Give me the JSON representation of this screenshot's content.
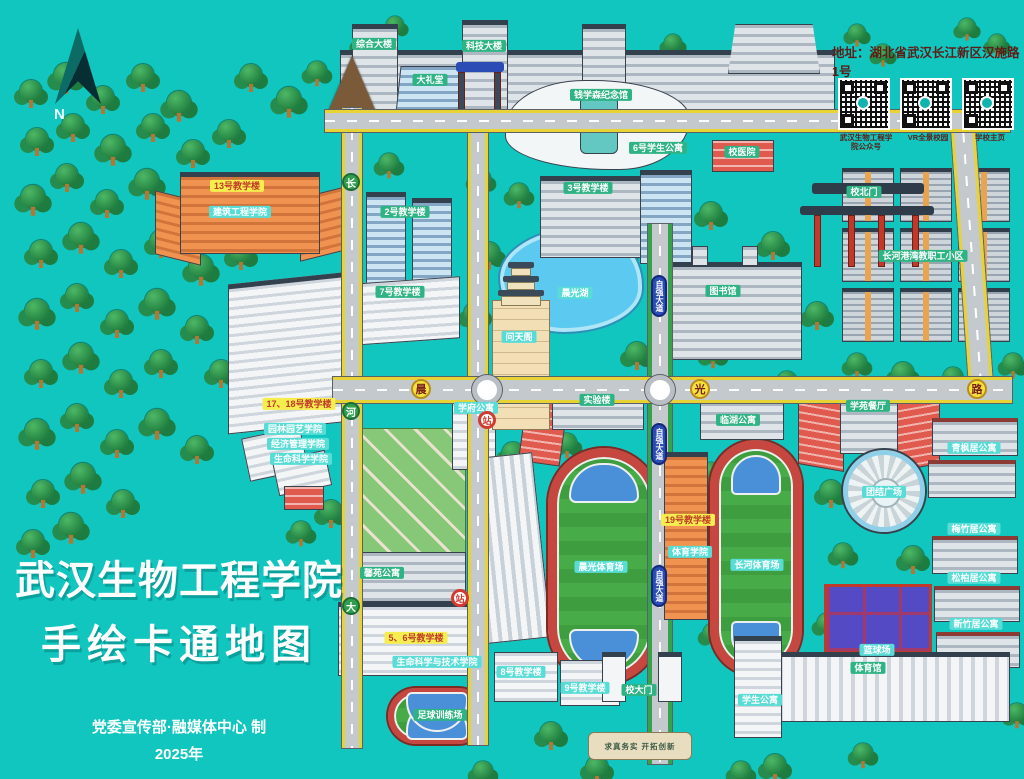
{
  "map": {
    "title": {
      "line1": "武汉生物工程学院",
      "line2": "手绘卡通地图",
      "credit": "党委宣传部·融媒体中心 制",
      "year": "2025年"
    },
    "address": "地址：湖北省武汉长江新区汉施路1号",
    "compass_label": "N",
    "qr_codes": [
      {
        "label": "武汉生物工程学院公众号"
      },
      {
        "label": "VR全景校园"
      },
      {
        "label": "学校主页"
      }
    ],
    "gate_motto": "求真务实 开拓创新",
    "colors": {
      "background": "#10c6bf",
      "label_green": "#2eb384",
      "label_yellow": "#f6ee4e",
      "label_cyan": "#58ddd6",
      "road": "#c3c9cd",
      "road_edge": "#e8d335",
      "lake": "#5bc9f0",
      "field_green": "#3e9e3f",
      "track_red": "#c5473f"
    },
    "pois": [
      {
        "id": "poi-zonghe-tower",
        "label": "综合大楼",
        "x": 374,
        "y": 44,
        "v": "green"
      },
      {
        "id": "poi-keji-tower",
        "label": "科技大楼",
        "x": 484,
        "y": 46,
        "v": "green"
      },
      {
        "id": "poi-dalitang",
        "label": "大礼堂",
        "x": 430,
        "y": 80,
        "v": "green"
      },
      {
        "id": "poi-qianxuesen-hall",
        "label": "钱学森纪念馆",
        "x": 601,
        "y": 95,
        "v": "green"
      },
      {
        "id": "poi-xiaoyiyuan",
        "label": "校医院",
        "x": 742,
        "y": 152,
        "v": "green"
      },
      {
        "id": "poi-xuesheng-gongyu-6",
        "label": "6号学生公寓",
        "x": 658,
        "y": 148,
        "v": "green"
      },
      {
        "id": "poi-xiao-bei-men",
        "label": "校北门",
        "x": 864,
        "y": 192,
        "v": "green"
      },
      {
        "id": "poi-jiaoxuelou-13",
        "label": "13号教学楼",
        "x": 237,
        "y": 186,
        "v": "yellow"
      },
      {
        "id": "poi-jianzhu-xueyuan",
        "label": "建筑工程学院",
        "x": 240,
        "y": 212,
        "v": "cyan"
      },
      {
        "id": "poi-jiaoxuelou-2",
        "label": "2号教学楼",
        "x": 405,
        "y": 212,
        "v": "green"
      },
      {
        "id": "poi-jiaoxuelou-3",
        "label": "3号教学楼",
        "x": 588,
        "y": 188,
        "v": "green"
      },
      {
        "id": "poi-jiaoxuelou-7",
        "label": "7号教学楼",
        "x": 400,
        "y": 292,
        "v": "green"
      },
      {
        "id": "poi-chenguang-lake",
        "label": "晨光湖",
        "x": 575,
        "y": 293,
        "v": "cyan"
      },
      {
        "id": "poi-wentiange",
        "label": "问天阁",
        "x": 519,
        "y": 337,
        "v": "cyan"
      },
      {
        "id": "poi-tushuguan",
        "label": "图书馆",
        "x": 723,
        "y": 291,
        "v": "green"
      },
      {
        "id": "poi-changhe-gangwan",
        "label": "长河港湾教职工小区",
        "x": 923,
        "y": 256,
        "v": "green"
      },
      {
        "id": "poi-jiaoxuelou-17-18",
        "label": "17、18号教学楼",
        "x": 299,
        "y": 404,
        "v": "yellow"
      },
      {
        "id": "poi-yuanlin-xueyuan",
        "label": "园林园艺学院",
        "x": 295,
        "y": 429,
        "v": "cyan"
      },
      {
        "id": "poi-jingguan-xueyuan",
        "label": "经济管理学院",
        "x": 298,
        "y": 444,
        "v": "cyan"
      },
      {
        "id": "poi-shengming-xueyuan",
        "label": "生命科学学院",
        "x": 301,
        "y": 459,
        "v": "cyan"
      },
      {
        "id": "poi-xuefu-gongyu",
        "label": "学府公寓",
        "x": 476,
        "y": 408,
        "v": "cyan"
      },
      {
        "id": "poi-shiyanlou",
        "label": "实验楼",
        "x": 597,
        "y": 400,
        "v": "green"
      },
      {
        "id": "poi-linhu-gongyu",
        "label": "临湖公寓",
        "x": 738,
        "y": 420,
        "v": "green"
      },
      {
        "id": "poi-xueyuan-canting",
        "label": "学苑餐厅",
        "x": 868,
        "y": 406,
        "v": "green"
      },
      {
        "id": "poi-tuanjie-guangchang",
        "label": "团结广场",
        "x": 884,
        "y": 492,
        "v": "cyan"
      },
      {
        "id": "poi-jiaoxuelou-19",
        "label": "19号教学楼",
        "x": 688,
        "y": 520,
        "v": "yellow"
      },
      {
        "id": "poi-tiyu-xueyuan",
        "label": "体育学院",
        "x": 690,
        "y": 552,
        "v": "cyan"
      },
      {
        "id": "poi-chenguang-stadium",
        "label": "晨光体育场",
        "x": 601,
        "y": 567,
        "v": "cyan"
      },
      {
        "id": "poi-changhe-stadium",
        "label": "长河体育场",
        "x": 757,
        "y": 565,
        "v": "cyan"
      },
      {
        "id": "poi-qingfengju",
        "label": "青枫居公寓",
        "x": 974,
        "y": 448,
        "v": "cyan"
      },
      {
        "id": "poi-meizhuju",
        "label": "梅竹居公寓",
        "x": 974,
        "y": 529,
        "v": "cyan"
      },
      {
        "id": "poi-songbaiju",
        "label": "松柏居公寓",
        "x": 974,
        "y": 578,
        "v": "cyan"
      },
      {
        "id": "poi-xinzhuju",
        "label": "新竹居公寓",
        "x": 976,
        "y": 624,
        "v": "cyan"
      },
      {
        "id": "poi-lanqiuchang",
        "label": "篮球场",
        "x": 877,
        "y": 650,
        "v": "cyan"
      },
      {
        "id": "poi-tiyuguan",
        "label": "体育馆",
        "x": 868,
        "y": 668,
        "v": "green"
      },
      {
        "id": "poi-xinyuan-gongyu",
        "label": "馨苑公寓",
        "x": 382,
        "y": 573,
        "v": "green"
      },
      {
        "id": "poi-jiaoxuelou-5-6",
        "label": "5、6号教学楼",
        "x": 416,
        "y": 638,
        "v": "yellow"
      },
      {
        "id": "poi-shengming-jishu",
        "label": "生命科学与技术学院",
        "x": 437,
        "y": 662,
        "v": "cyan"
      },
      {
        "id": "poi-zuqiu-xunlianchang",
        "label": "足球训练场",
        "x": 440,
        "y": 715,
        "v": "green"
      },
      {
        "id": "poi-jiaoxuelou-8",
        "label": "8号教学楼",
        "x": 521,
        "y": 672,
        "v": "cyan"
      },
      {
        "id": "poi-jiaoxuelou-9",
        "label": "9号教学楼",
        "x": 585,
        "y": 688,
        "v": "cyan"
      },
      {
        "id": "poi-xuesheng-gongyu-r",
        "label": "学生公寓",
        "x": 760,
        "y": 700,
        "v": "cyan"
      },
      {
        "id": "poi-xiao-da-men",
        "label": "校大门",
        "x": 639,
        "y": 690,
        "v": "green"
      }
    ],
    "road_badges": [
      {
        "id": "road-badge-chen",
        "label": "晨",
        "x": 421,
        "y": 389,
        "v": "yellow-circle"
      },
      {
        "id": "road-badge-guang",
        "label": "光",
        "x": 700,
        "y": 389,
        "v": "yellow-circle"
      },
      {
        "id": "road-badge-lu",
        "label": "路",
        "x": 977,
        "y": 389,
        "v": "yellow-circle"
      },
      {
        "id": "road-badge-ziqiang-1",
        "label": "自强大道",
        "x": 659,
        "y": 296,
        "v": "blue-oval"
      },
      {
        "id": "road-badge-ziqiang-2",
        "label": "自强大道",
        "x": 659,
        "y": 444,
        "v": "blue-oval"
      },
      {
        "id": "road-badge-ziqiang-3",
        "label": "自强大道",
        "x": 659,
        "y": 586,
        "v": "blue-oval"
      },
      {
        "id": "road-badge-chang",
        "label": "长",
        "x": 351,
        "y": 182,
        "v": "green-circle"
      },
      {
        "id": "road-badge-he",
        "label": "河",
        "x": 351,
        "y": 411,
        "v": "green-circle"
      },
      {
        "id": "road-badge-da",
        "label": "大",
        "x": 351,
        "y": 606,
        "v": "green-circle"
      },
      {
        "id": "road-badge-stop-1",
        "label": "站",
        "x": 487,
        "y": 420,
        "v": "red-circle"
      },
      {
        "id": "road-badge-stop-2",
        "label": "站",
        "x": 460,
        "y": 598,
        "v": "red-circle"
      }
    ]
  }
}
